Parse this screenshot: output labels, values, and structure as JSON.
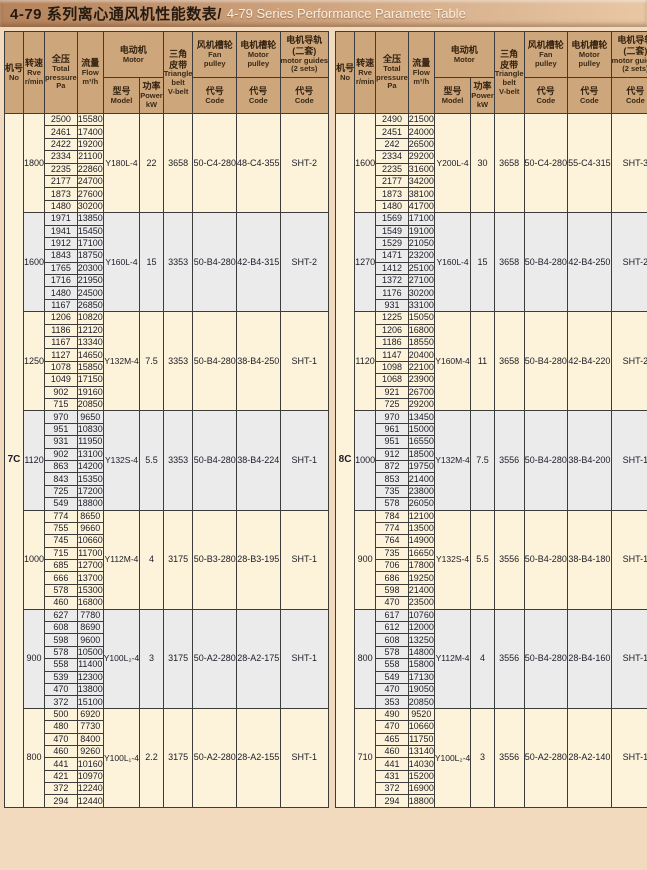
{
  "title": {
    "zh": "4-79 系列离心通风机性能数表/",
    "en": "4-79 Series Performance Paramete Table"
  },
  "colors": {
    "page_bg": "#f1dabe",
    "title_bg_left": "#b5835c",
    "title_bg_right": "#e9c7a5",
    "title_text_zh": "#241a10",
    "title_text_en": "#f8f0e5",
    "header_bg": "#cda67c",
    "row_cream": "#fdf3da",
    "row_gray": "#ebebec",
    "border": "#3c3c3c"
  },
  "header": {
    "no": [
      "机号",
      "No"
    ],
    "speed": [
      "转速",
      "Rve",
      "r/min"
    ],
    "pressure": [
      "全压",
      "Total",
      "pressure",
      "Pa"
    ],
    "flow": [
      "流量",
      "Flow",
      "m³/h"
    ],
    "motor": [
      "电动机",
      "Motor"
    ],
    "model": [
      "型号",
      "Model"
    ],
    "power": [
      "功率",
      "Power",
      "kW"
    ],
    "belt": [
      "三角",
      "皮带",
      "Triangle",
      "belt",
      "V-belt"
    ],
    "fan_pulley": [
      "风机槽轮",
      "Fan",
      "pulley"
    ],
    "motor_pulley": [
      "电机槽轮",
      "Motor",
      "pulley"
    ],
    "guides": [
      "电机导轨",
      "(二套)",
      "motor guides",
      "(2 sets)"
    ],
    "code": [
      "代号",
      "Code"
    ]
  },
  "tables": [
    {
      "machine_no": "7C",
      "groups": [
        {
          "speed": "1800",
          "rows": [
            [
              "2500",
              "15580"
            ],
            [
              "2461",
              "17400"
            ],
            [
              "2422",
              "19200"
            ],
            [
              "2334",
              "21100"
            ],
            [
              "2235",
              "22860"
            ],
            [
              "2177",
              "24700"
            ],
            [
              "1873",
              "27600"
            ],
            [
              "1480",
              "30200"
            ]
          ],
          "model": "Y180L-4",
          "power": "22",
          "belt": "3658",
          "fan_pulley": "50-C4-280",
          "motor_pulley": "48-C4-355",
          "guide": "SHT-2"
        },
        {
          "speed": "1600",
          "rows": [
            [
              "1971",
              "13850"
            ],
            [
              "1941",
              "15450"
            ],
            [
              "1912",
              "17100"
            ],
            [
              "1843",
              "18750"
            ],
            [
              "1765",
              "20300"
            ],
            [
              "1716",
              "21950"
            ],
            [
              "1480",
              "24500"
            ],
            [
              "1167",
              "26850"
            ]
          ],
          "model": "Y160L-4",
          "power": "15",
          "belt": "3353",
          "fan_pulley": "50-B4-280",
          "motor_pulley": "42-B4-315",
          "guide": "SHT-2"
        },
        {
          "speed": "1250",
          "rows": [
            [
              "1206",
              "10820"
            ],
            [
              "1186",
              "12120"
            ],
            [
              "1167",
              "13340"
            ],
            [
              "1127",
              "14650"
            ],
            [
              "1078",
              "15850"
            ],
            [
              "1049",
              "17150"
            ],
            [
              "902",
              "19160"
            ],
            [
              "715",
              "20850"
            ]
          ],
          "model": "Y132M-4",
          "power": "7.5",
          "belt": "3353",
          "fan_pulley": "50-B4-280",
          "motor_pulley": "38-B4-250",
          "guide": "SHT-1"
        },
        {
          "speed": "1120",
          "rows": [
            [
              "970",
              "9650"
            ],
            [
              "951",
              "10830"
            ],
            [
              "931",
              "11950"
            ],
            [
              "902",
              "13100"
            ],
            [
              "863",
              "14200"
            ],
            [
              "843",
              "15350"
            ],
            [
              "725",
              "17200"
            ],
            [
              "549",
              "18800"
            ]
          ],
          "model": "Y132S-4",
          "power": "5.5",
          "belt": "3353",
          "fan_pulley": "50-B4-280",
          "motor_pulley": "38-B4-224",
          "guide": "SHT-1"
        },
        {
          "speed": "1000",
          "rows": [
            [
              "774",
              "8650"
            ],
            [
              "755",
              "9660"
            ],
            [
              "745",
              "10660"
            ],
            [
              "715",
              "11700"
            ],
            [
              "685",
              "12700"
            ],
            [
              "666",
              "13700"
            ],
            [
              "578",
              "15300"
            ],
            [
              "460",
              "16800"
            ]
          ],
          "model": "Y112M-4",
          "power": "4",
          "belt": "3175",
          "fan_pulley": "50-B3-280",
          "motor_pulley": "28-B3-195",
          "guide": "SHT-1"
        },
        {
          "speed": "900",
          "rows": [
            [
              "627",
              "7780"
            ],
            [
              "608",
              "8690"
            ],
            [
              "598",
              "9600"
            ],
            [
              "578",
              "10500"
            ],
            [
              "558",
              "11400"
            ],
            [
              "539",
              "12300"
            ],
            [
              "470",
              "13800"
            ],
            [
              "372",
              "15100"
            ]
          ],
          "model": "Y100L₂-4",
          "power": "3",
          "belt": "3175",
          "fan_pulley": "50-A2-280",
          "motor_pulley": "28-A2-175",
          "guide": "SHT-1"
        },
        {
          "speed": "800",
          "rows": [
            [
              "500",
              "6920"
            ],
            [
              "480",
              "7730"
            ],
            [
              "470",
              "8400"
            ],
            [
              "460",
              "9260"
            ],
            [
              "441",
              "10160"
            ],
            [
              "421",
              "10970"
            ],
            [
              "372",
              "12240"
            ],
            [
              "294",
              "12440"
            ]
          ],
          "model": "Y100L₁-4",
          "power": "2.2",
          "belt": "3175",
          "fan_pulley": "50-A2-280",
          "motor_pulley": "28-A2-155",
          "guide": "SHT-1"
        }
      ]
    },
    {
      "machine_no": "8C",
      "groups": [
        {
          "speed": "1600",
          "rows": [
            [
              "2490",
              "21500"
            ],
            [
              "2451",
              "24000"
            ],
            [
              "242",
              "26500"
            ],
            [
              "2334",
              "29200"
            ],
            [
              "2235",
              "31600"
            ],
            [
              "2177",
              "34200"
            ],
            [
              "1873",
              "38100"
            ],
            [
              "1480",
              "41700"
            ]
          ],
          "model": "Y200L-4",
          "power": "30",
          "belt": "3658",
          "fan_pulley": "50-C4-280",
          "motor_pulley": "55-C4-315",
          "guide": "SHT-3"
        },
        {
          "speed": "1270",
          "rows": [
            [
              "1569",
              "17100"
            ],
            [
              "1549",
              "19100"
            ],
            [
              "1529",
              "21050"
            ],
            [
              "1471",
              "23200"
            ],
            [
              "1412",
              "25100"
            ],
            [
              "1372",
              "27100"
            ],
            [
              "1176",
              "30200"
            ],
            [
              "931",
              "33100"
            ]
          ],
          "model": "Y160L-4",
          "power": "15",
          "belt": "3658",
          "fan_pulley": "50-B4-280",
          "motor_pulley": "42-B4-250",
          "guide": "SHT-2"
        },
        {
          "speed": "1120",
          "rows": [
            [
              "1225",
              "15050"
            ],
            [
              "1206",
              "16800"
            ],
            [
              "1186",
              "18550"
            ],
            [
              "1147",
              "20400"
            ],
            [
              "1098",
              "22100"
            ],
            [
              "1068",
              "23900"
            ],
            [
              "921",
              "26700"
            ],
            [
              "725",
              "29200"
            ]
          ],
          "model": "Y160M-4",
          "power": "11",
          "belt": "3658",
          "fan_pulley": "50-B4-280",
          "motor_pulley": "42-B4-220",
          "guide": "SHT-2"
        },
        {
          "speed": "1000",
          "rows": [
            [
              "970",
              "13450"
            ],
            [
              "961",
              "15000"
            ],
            [
              "951",
              "16550"
            ],
            [
              "912",
              "18500"
            ],
            [
              "872",
              "19750"
            ],
            [
              "853",
              "21400"
            ],
            [
              "735",
              "23800"
            ],
            [
              "578",
              "26050"
            ]
          ],
          "model": "Y132M-4",
          "power": "7.5",
          "belt": "3556",
          "fan_pulley": "50-B4-280",
          "motor_pulley": "38-B4-200",
          "guide": "SHT-1"
        },
        {
          "speed": "900",
          "rows": [
            [
              "784",
              "12100"
            ],
            [
              "774",
              "13500"
            ],
            [
              "764",
              "14900"
            ],
            [
              "735",
              "16650"
            ],
            [
              "706",
              "17800"
            ],
            [
              "686",
              "19250"
            ],
            [
              "598",
              "21400"
            ],
            [
              "470",
              "23500"
            ]
          ],
          "model": "Y132S-4",
          "power": "5.5",
          "belt": "3556",
          "fan_pulley": "50-B4-280",
          "motor_pulley": "38-B4-180",
          "guide": "SHT-1"
        },
        {
          "speed": "800",
          "rows": [
            [
              "617",
              "10760"
            ],
            [
              "612",
              "12000"
            ],
            [
              "608",
              "13250"
            ],
            [
              "578",
              "14800"
            ],
            [
              "558",
              "15800"
            ],
            [
              "549",
              "17130"
            ],
            [
              "470",
              "19050"
            ],
            [
              "353",
              "20850"
            ]
          ],
          "model": "Y112M-4",
          "power": "4",
          "belt": "3556",
          "fan_pulley": "50-B4-280",
          "motor_pulley": "28-B4-160",
          "guide": "SHT-1"
        },
        {
          "speed": "710",
          "rows": [
            [
              "490",
              "9520"
            ],
            [
              "470",
              "10660"
            ],
            [
              "465",
              "11750"
            ],
            [
              "460",
              "13140"
            ],
            [
              "441",
              "14030"
            ],
            [
              "431",
              "15200"
            ],
            [
              "372",
              "16900"
            ],
            [
              "294",
              "18800"
            ]
          ],
          "model": "Y100L₂-4",
          "power": "3",
          "belt": "3556",
          "fan_pulley": "50-A2-280",
          "motor_pulley": "28-A2-140",
          "guide": "SHT-1"
        }
      ]
    }
  ]
}
